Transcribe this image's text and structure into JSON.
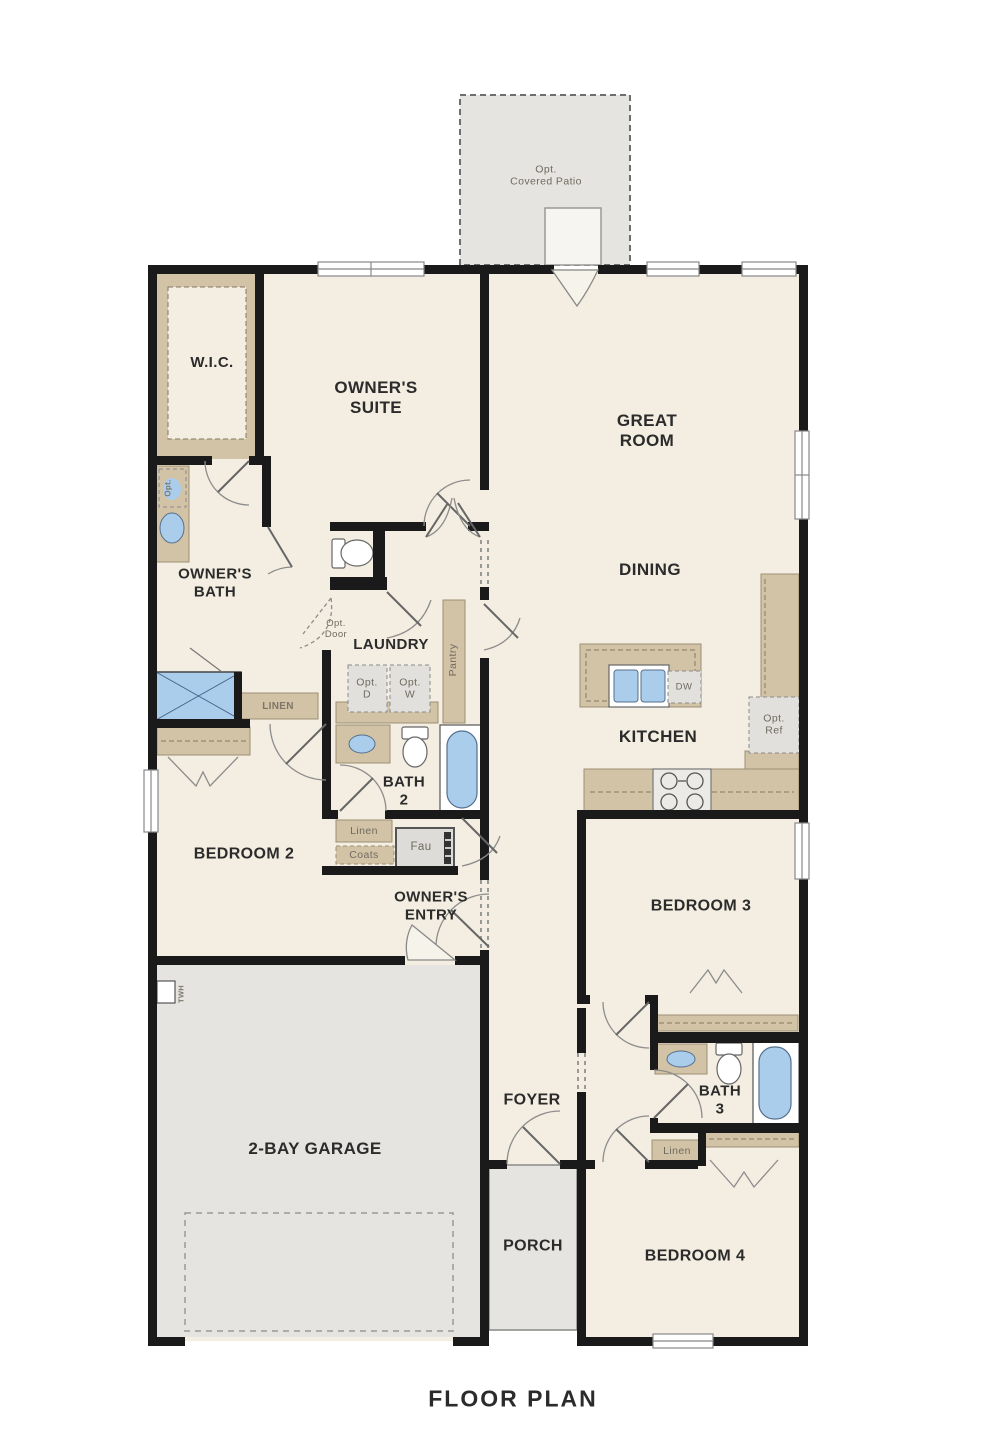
{
  "page_title": "FLOOR PLAN",
  "colors": {
    "wall": "#1a1a1a",
    "floor": "#f3eee1",
    "concrete": "#e6e4e0",
    "cabinet_tan": "#d2c3a6",
    "fixture_blue": "#abcdec",
    "appliance_gray": "#e2e0dc",
    "label_dark": "#2b2b2b",
    "label_gray": "#7d7668"
  },
  "labels": {
    "patio": "Opt.\nCovered Patio",
    "wic": "W.I.C.",
    "owners_suite": "OWNER'S\nSUITE",
    "great_room": "GREAT\nROOM",
    "dining": "DINING",
    "owners_bath": "OWNER'S\nBATH",
    "laundry": "LAUNDRY",
    "pantry": "Pantry",
    "opt_door": "Opt.\nDoor",
    "opt_d": "Opt.\nD",
    "opt_w": "Opt.\nW",
    "dw": "DW",
    "opt_ref": "Opt.\nRef",
    "kitchen": "KITCHEN",
    "linen_hall": "LINEN",
    "bath2": "BATH\n2",
    "linen2": "Linen",
    "coats": "Coats",
    "fau": "Fau",
    "owners_entry": "OWNER'S\nENTRY",
    "bedroom2": "BEDROOM 2",
    "bedroom3": "BEDROOM 3",
    "bedroom4": "BEDROOM 4",
    "bath3": "BATH\n3",
    "linen3": "Linen",
    "foyer": "FOYER",
    "porch": "PORCH",
    "garage": "2-BAY GARAGE",
    "twh": "TWH",
    "opt_sink": "Opt.",
    "caption": "FLOOR PLAN"
  }
}
